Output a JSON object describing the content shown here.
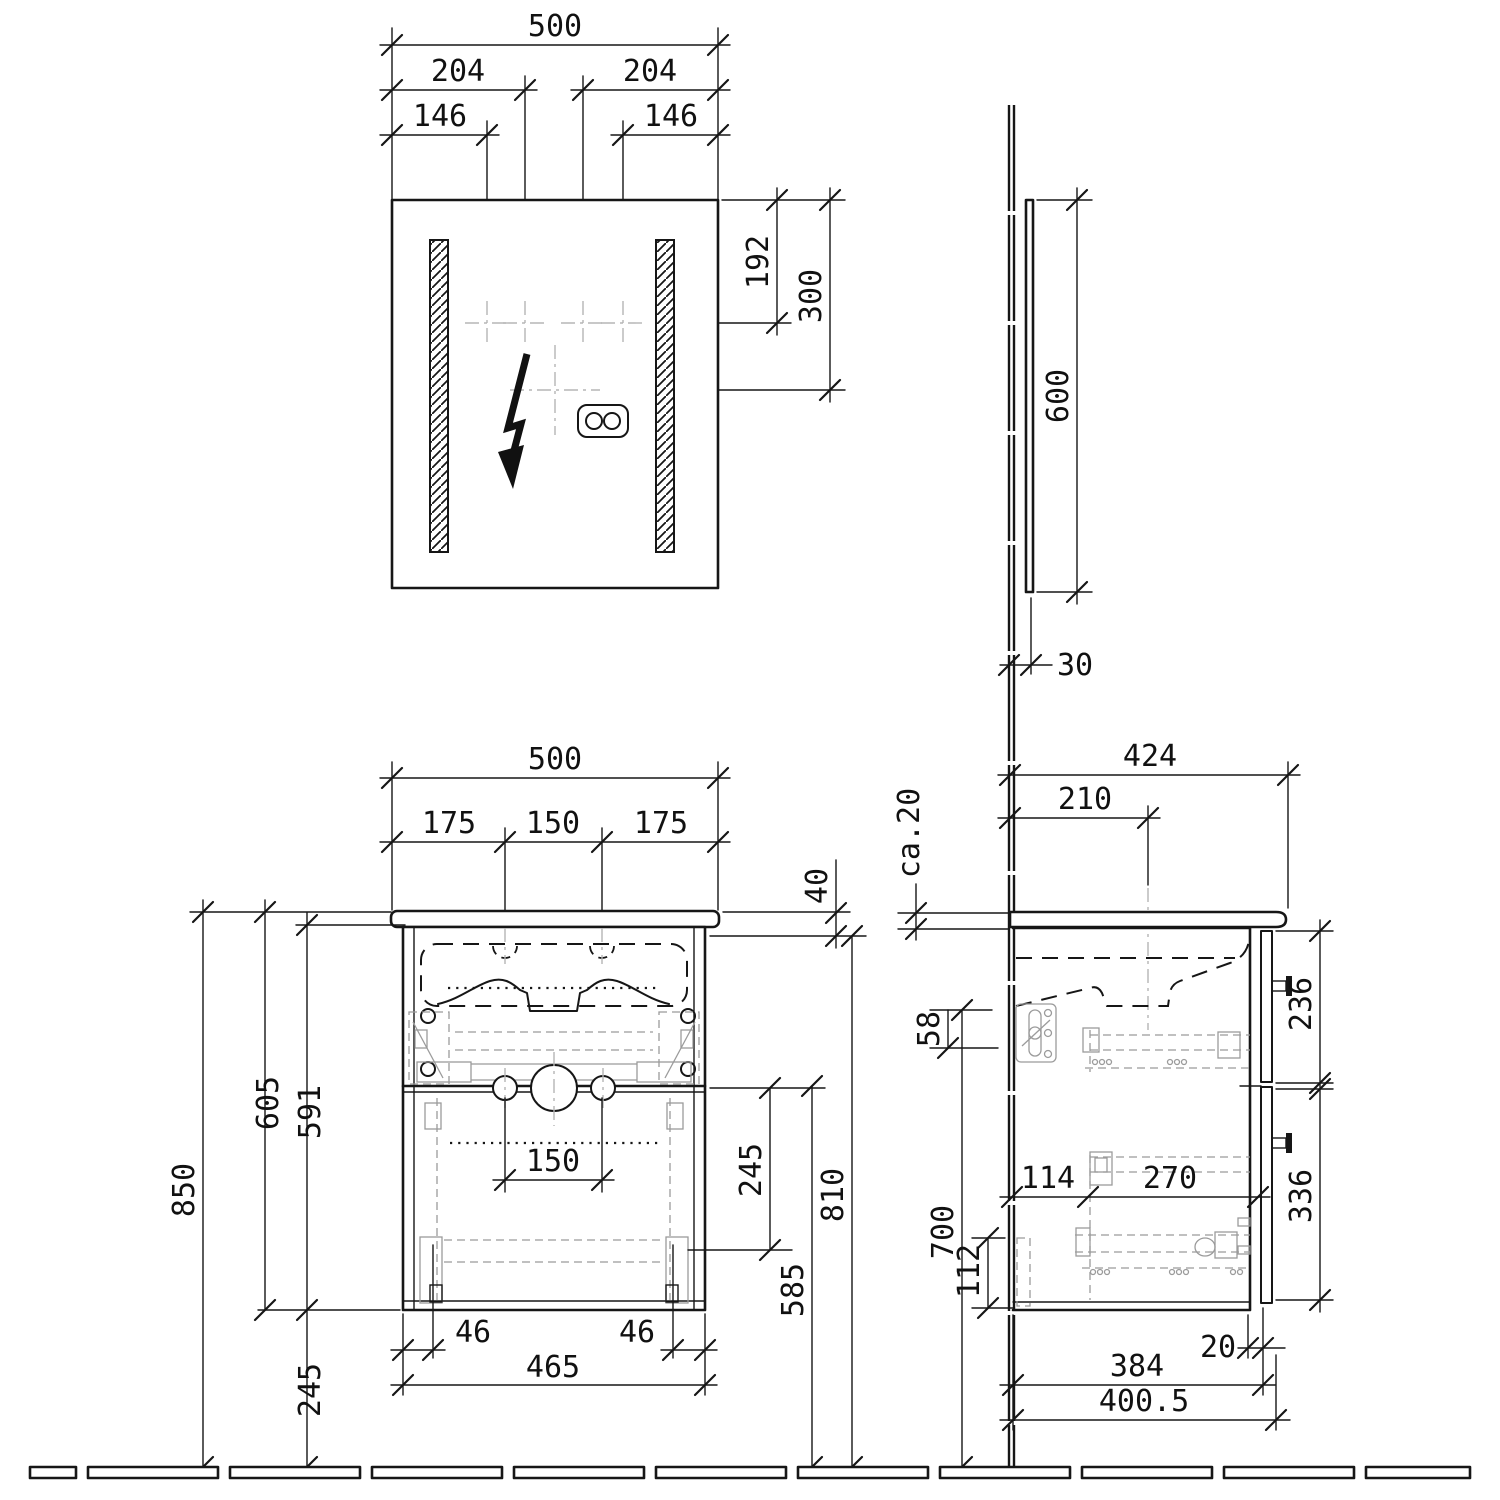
{
  "drawing": {
    "type": "bathroom-vanity-technical-drawing",
    "units": "mm",
    "views": [
      "mirror-front",
      "mirror-side",
      "vanity-front",
      "vanity-side"
    ]
  },
  "colors": {
    "ink": "#161616",
    "hardware": "#9b9b9b",
    "centerline": "#b5b5b5",
    "background": "#ffffff"
  },
  "icons": {
    "lightning": "electrical-connection-icon",
    "socket": "double-socket-icon"
  },
  "dims": {
    "mf_width": "500",
    "mf_c_left": "204",
    "mf_c_right": "204",
    "mf_h_left": "146",
    "mf_h_right": "146",
    "mf_v1": "192",
    "mf_v2": "300",
    "ms_height": "600",
    "ms_depth": "30",
    "vf_width": "500",
    "vf_left": "175",
    "vf_center": "150",
    "vf_right": "175",
    "vf_top": "40",
    "vf_total_h": "850",
    "vf_cab_h": "605",
    "vf_carc_h": "591",
    "vf_clear": "245",
    "vf_drain_sp": "150",
    "vf_drain_off": "245",
    "vf_lower": "585",
    "vf_under": "810",
    "vf_foot_l": "46",
    "vf_foot_r": "46",
    "vf_body_w": "465",
    "vs_depth": "424",
    "vs_drain": "210",
    "vs_top": "ca.20",
    "vs_bracket": "58",
    "vs_h700": "700",
    "vs_front_top": "236",
    "vs_front_bot": "336",
    "vs_s114": "114",
    "vs_s270": "270",
    "vs_back112": "112",
    "vs_gap20": "20",
    "vs_body": "384",
    "vs_total": "400.5"
  }
}
